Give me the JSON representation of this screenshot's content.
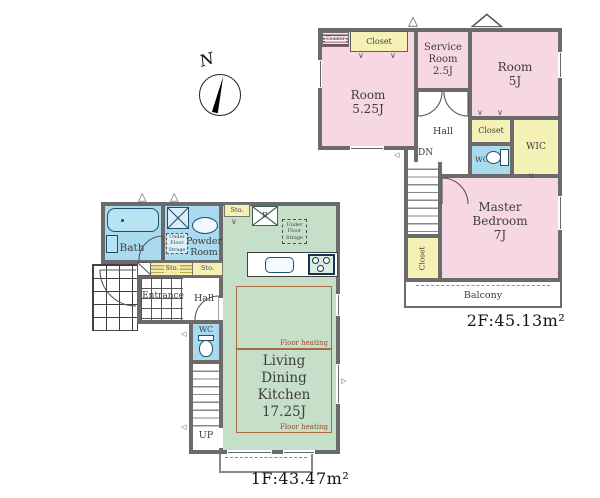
{
  "colors": {
    "wall": "#6b6b6b",
    "room_pink": "#f8d7e4",
    "closet_yellow": "#f5f0b6",
    "wet_blue": "#a9daee",
    "ldk_green": "#c6dfc8",
    "fixture_outline": "#1d4f6e",
    "heating_text": "#9c4a2a",
    "label_text": "#3d3d3d"
  },
  "compass": {
    "n": "N"
  },
  "f2": {
    "counter": "Counter",
    "closet": "Closet",
    "room_525": "Room\n5.25J",
    "service": "Service\nRoom\n2.5J",
    "room_5": "Room\n5J",
    "hall": "Hall",
    "dn": "DN",
    "wc": "WC",
    "wic": "WIC",
    "master": "Master\nBedroom\n7J",
    "balcony": "Balcony",
    "area": "2F:45.13m²"
  },
  "f1": {
    "bath": "Bath",
    "under_floor": "Under\nFloor\nStrage",
    "powder": "Powder\nRoom",
    "sto": "Sto.",
    "entrance": "Entrance",
    "hall": "Hall",
    "wc": "WC",
    "up": "UP",
    "fridge": "R",
    "ldk": "Living\nDining\nKitchen\n17.25J",
    "floor_heating": "Floor heating",
    "area": "1F:43.47m²"
  }
}
